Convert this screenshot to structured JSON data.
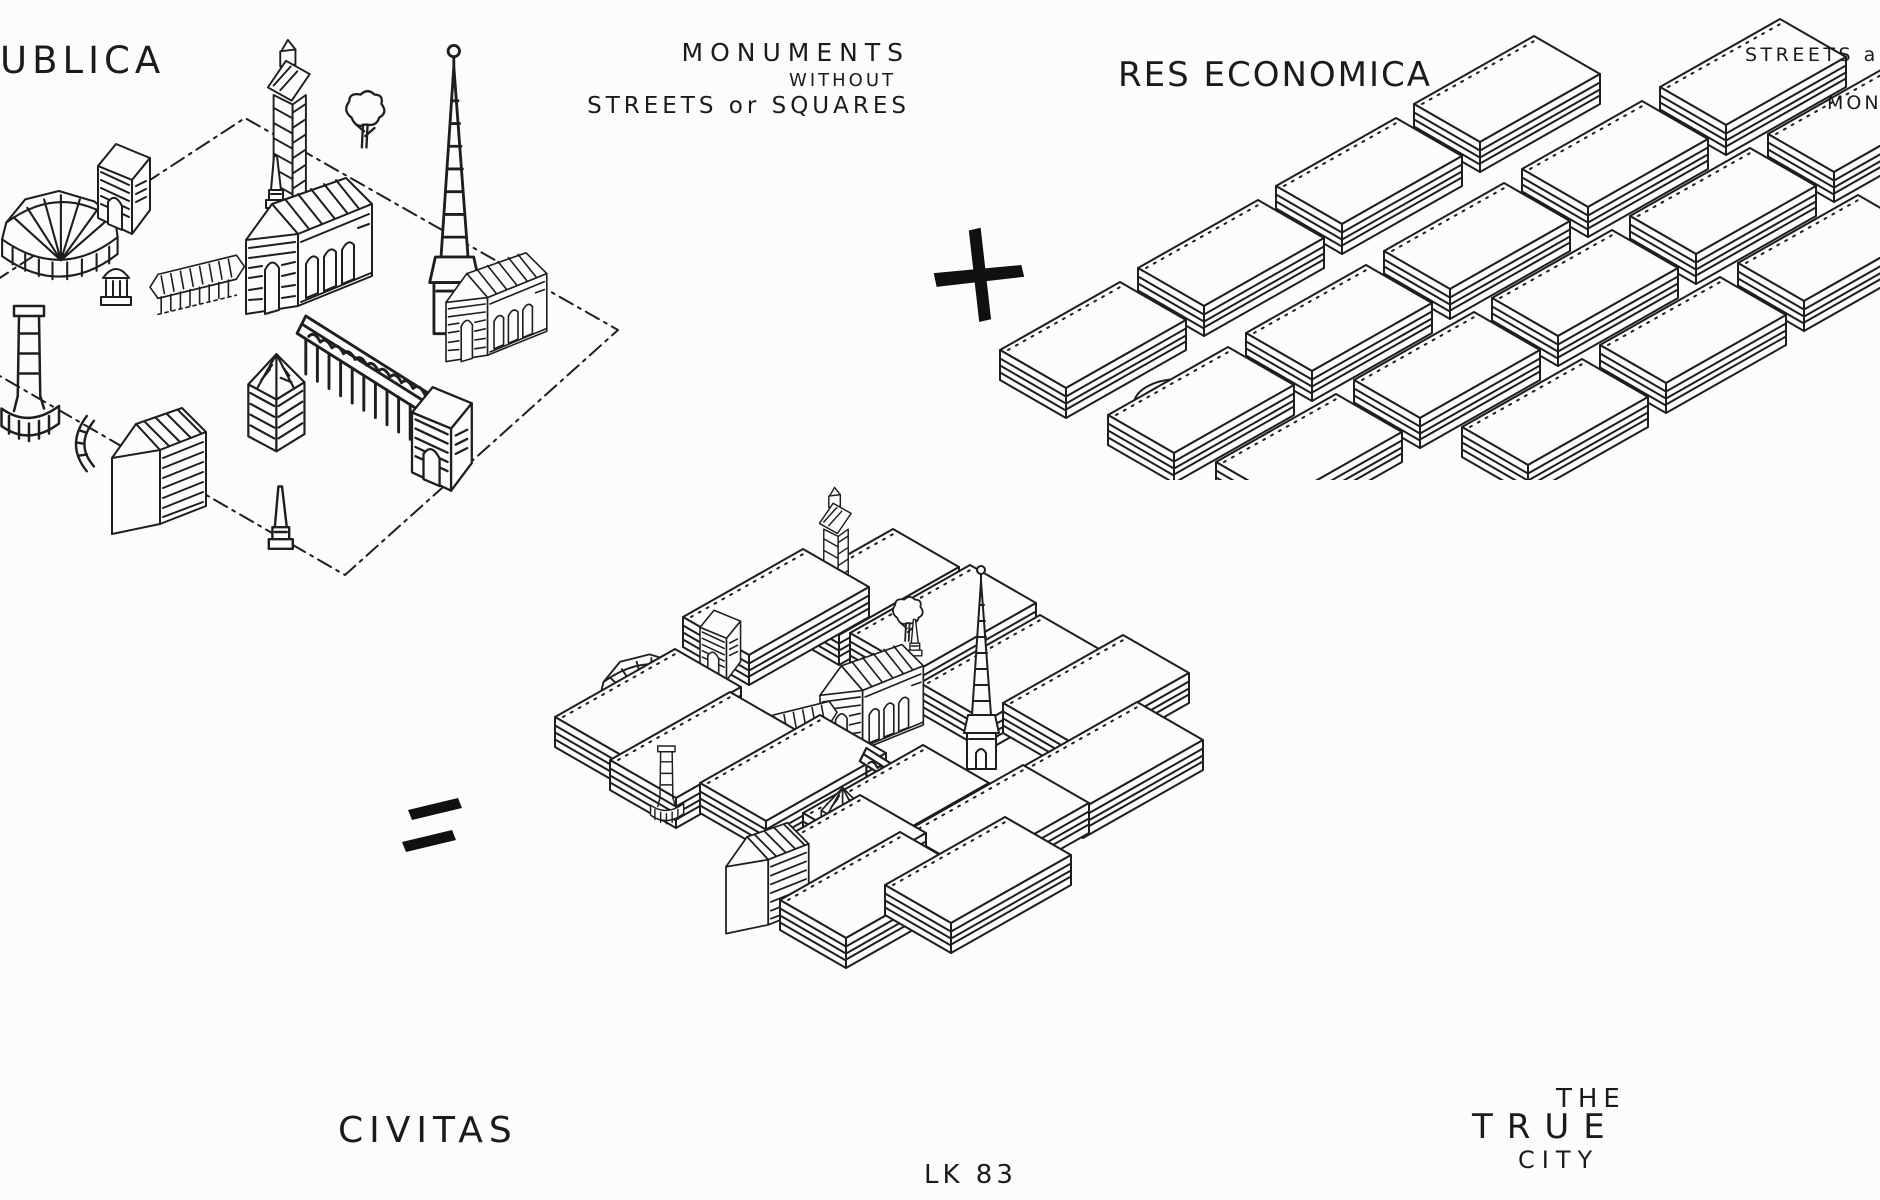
{
  "panels": {
    "res_publica": {
      "title": "UBLICA",
      "caption_lines": [
        "MONUMENTS",
        "WITHOUT",
        "STREETS or SQUARES"
      ],
      "depicts": [
        "amphitheatre",
        "triumphal-arch",
        "bell-tower",
        "obelisk",
        "tree",
        "church-spire",
        "colonnade",
        "basilica",
        "tempietto",
        "victory-column",
        "exedra",
        "gable-house",
        "pyramid-roof-house",
        "aqueduct",
        "dash-dot-ground-plane"
      ]
    },
    "res_economica": {
      "title": "RES ECONOMICA",
      "caption_lines": [
        "STREETS a",
        "MON"
      ],
      "depicts": [
        "city-block-grid",
        "circular-plaza"
      ]
    },
    "civitas": {
      "title": "CIVITAS",
      "caption_lines": [
        "THE",
        "TRUE",
        "CITY"
      ],
      "depicts": [
        "city-blocks",
        "amphitheatre",
        "triumphal-arch",
        "bell-tower",
        "obelisk",
        "tree",
        "church-spire",
        "colonnade",
        "basilica",
        "victory-column",
        "gable-house",
        "pyramid-roof-house",
        "aqueduct"
      ]
    }
  },
  "operators": {
    "plus": "+",
    "equals": "="
  },
  "signature": "LK 83",
  "colors": {
    "ink": "#1e1e1e",
    "paper": "#fcfcfa"
  }
}
